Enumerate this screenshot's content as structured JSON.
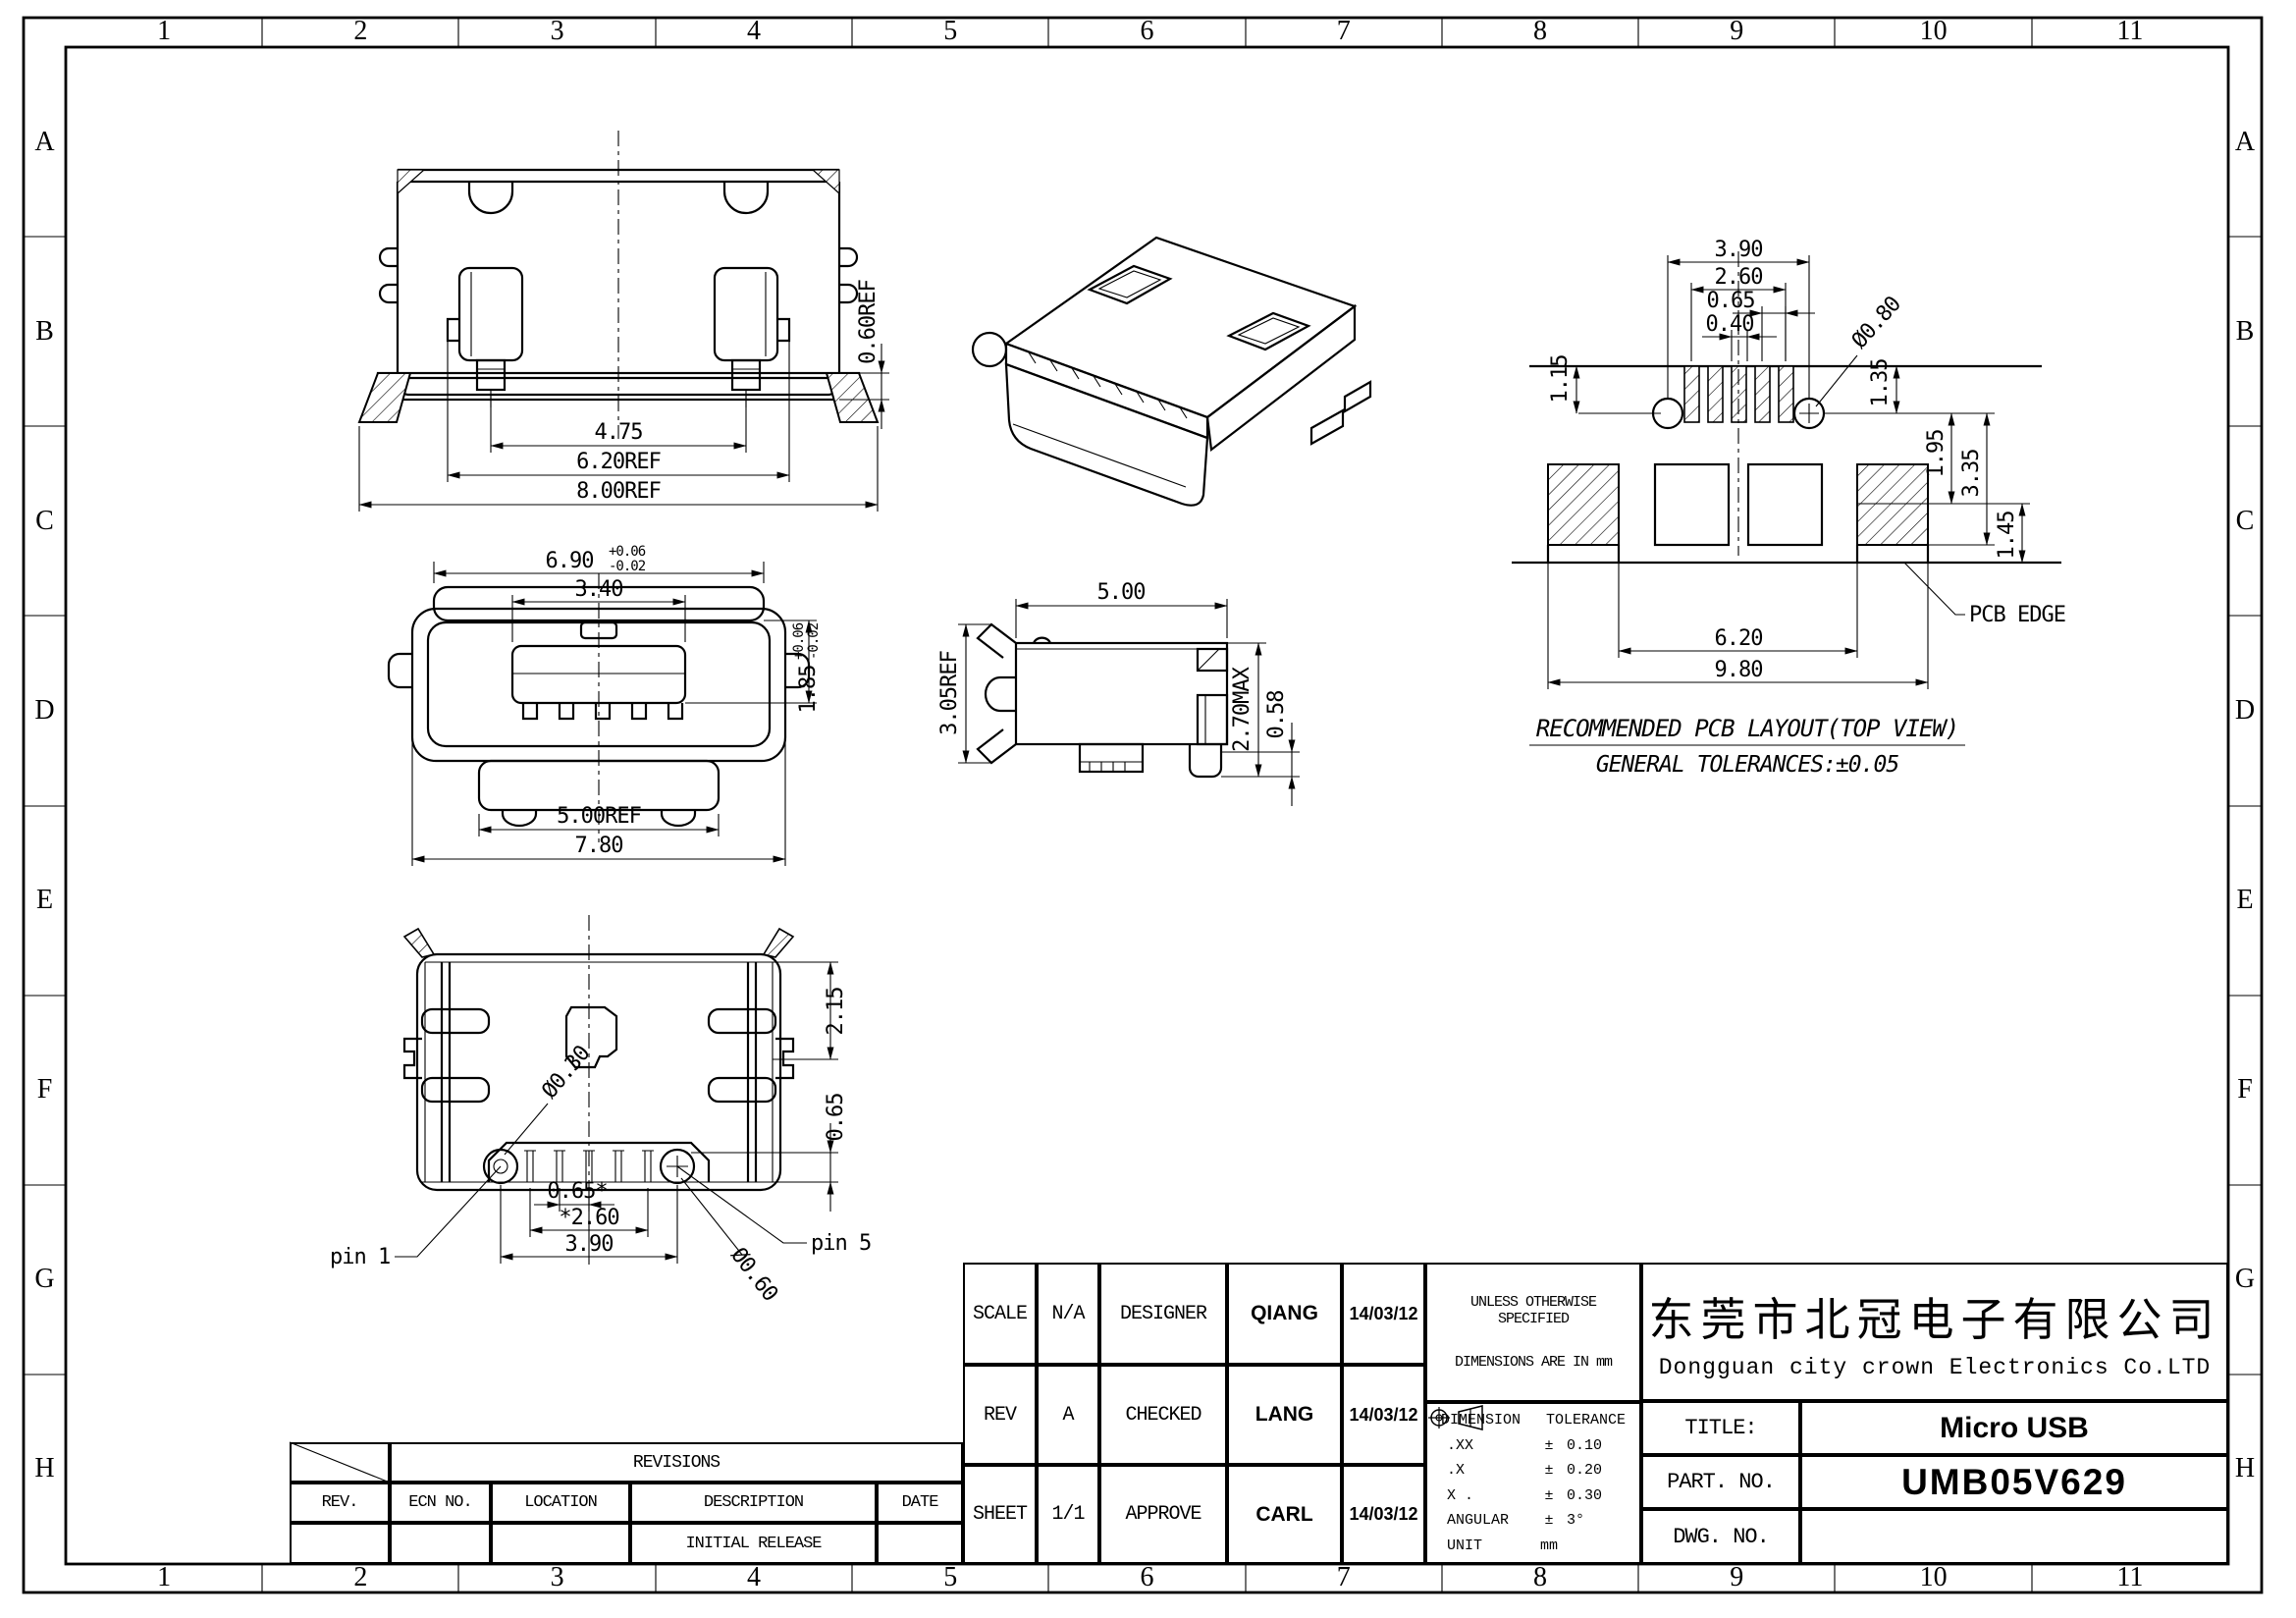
{
  "frame": {
    "columns": [
      "1",
      "2",
      "3",
      "4",
      "5",
      "6",
      "7",
      "8",
      "9",
      "10",
      "11"
    ],
    "rows": [
      "A",
      "B",
      "C",
      "D",
      "E",
      "F",
      "G",
      "H"
    ]
  },
  "views": {
    "front": {
      "dim_pin_span": "4.75",
      "dim_inner_width": "6.20REF",
      "dim_body_width": "8.00REF",
      "dim_flange_step": "0.60REF"
    },
    "mating": {
      "dim_shell_width": "6.90",
      "dim_shell_tol_plus": "+0.06",
      "dim_shell_tol_minus": "-0.02",
      "dim_tongue_width": "3.40",
      "dim_opening_height": "1.85",
      "dim_height_tol_plus": "+0.06",
      "dim_height_tol_minus": "-0.02",
      "dim_flange_width": "5.00REF",
      "dim_total_width": "7.80"
    },
    "side": {
      "dim_depth": "5.00",
      "dim_height": "3.05REF",
      "dim_max_height": "2.70MAX",
      "dim_pin": "0.58"
    },
    "bottom": {
      "dim_shell": "2.15",
      "dim_pin_zone": "0.65",
      "dim_hole_small": "Ø0.30",
      "pin1": "pin 1",
      "pin5": "pin 5",
      "dim_pitch": "0.65*",
      "dim_pins_span": "*2.60",
      "dim_holes_span": "3.90",
      "dim_hole_big": "Ø0.60"
    },
    "pcb": {
      "dim_hole_span": "3.90",
      "dim_pad_span": "2.60",
      "dim_pitch": "0.65",
      "dim_pad_width": "0.40",
      "dim_edge_to_hole": "1.15",
      "dim_hole_dia": "Ø0.80",
      "dim_hole_offset": "1.35",
      "dim_pad_top": "1.95",
      "dim_pad_bottom": "3.35",
      "dim_edge_gap": "1.45",
      "dim_inner_span": "6.20",
      "dim_outer_span": "9.80",
      "edge_label": "PCB EDGE",
      "caption": "RECOMMENDED PCB LAYOUT(TOP VIEW)",
      "tolerance_note": "GENERAL TOLERANCES:±0.05"
    }
  },
  "title_block": {
    "scale_label": "SCALE",
    "scale_value": "N/A",
    "designer_label": "DESIGNER",
    "designer_name": "QIANG",
    "designer_date": "14/03/12",
    "rev_label": "REV",
    "rev_value": "A",
    "checked_label": "CHECKED",
    "checked_name": "LANG",
    "checked_date": "14/03/12",
    "sheet_label": "SHEET",
    "sheet_value": "1/1",
    "approve_label": "APPROVE",
    "approve_name": "CARL",
    "approve_date": "14/03/12",
    "spec_line1": "UNLESS OTHERWISE SPECIFIED",
    "spec_line2": "DIMENSIONS ARE IN mm",
    "tol_header_dim": "DIMENSION",
    "tol_header_tol": "TOLERANCE",
    "tol_rows": [
      {
        "d": ".XX",
        "s": "±",
        "v": "0.10"
      },
      {
        "d": ".X",
        "s": "±",
        "v": "0.20"
      },
      {
        "d": "X .",
        "s": "±",
        "v": "0.30"
      },
      {
        "d": "ANGULAR",
        "s": "±",
        "v": "3°"
      },
      {
        "d": "UNIT",
        "s": "mm",
        "v": ""
      }
    ],
    "company_cn": "东莞市北冠电子有限公司",
    "company_en": "Dongguan city crown Electronics Co.LTD",
    "title_label": "TITLE:",
    "title_value": "Micro USB",
    "part_label": "PART. NO.",
    "part_value": "UMB05V629",
    "dwg_label": "DWG. NO.",
    "dwg_value": ""
  },
  "revisions": {
    "header": "REVISIONS",
    "columns": [
      "REV.",
      "ECN NO.",
      "LOCATION",
      "DESCRIPTION",
      "DATE"
    ],
    "rows": [
      [
        "",
        "",
        "",
        "INITIAL RELEASE",
        ""
      ]
    ]
  }
}
